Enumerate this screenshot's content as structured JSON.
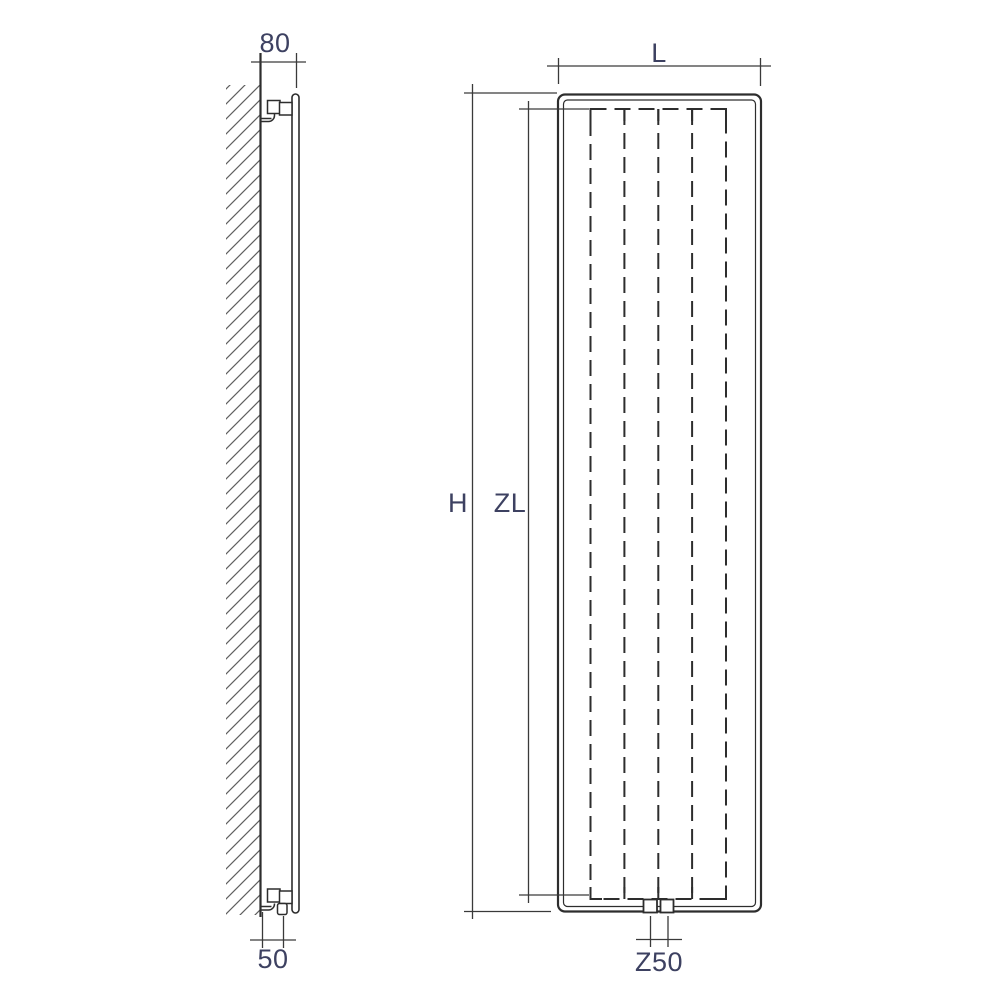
{
  "dimensions": {
    "side_view": {
      "top_offset": "80",
      "bottom_offset": "50"
    },
    "front_view": {
      "width": "L",
      "height": "H",
      "inner_length": "ZL",
      "connection_spacing": "Z50"
    }
  },
  "colors": {
    "background": "#ffffff",
    "object_line": "#2d2d2d",
    "dimension_line": "#3a3a3a",
    "text": "#3d4161",
    "hatch": "#5f5f5f"
  }
}
